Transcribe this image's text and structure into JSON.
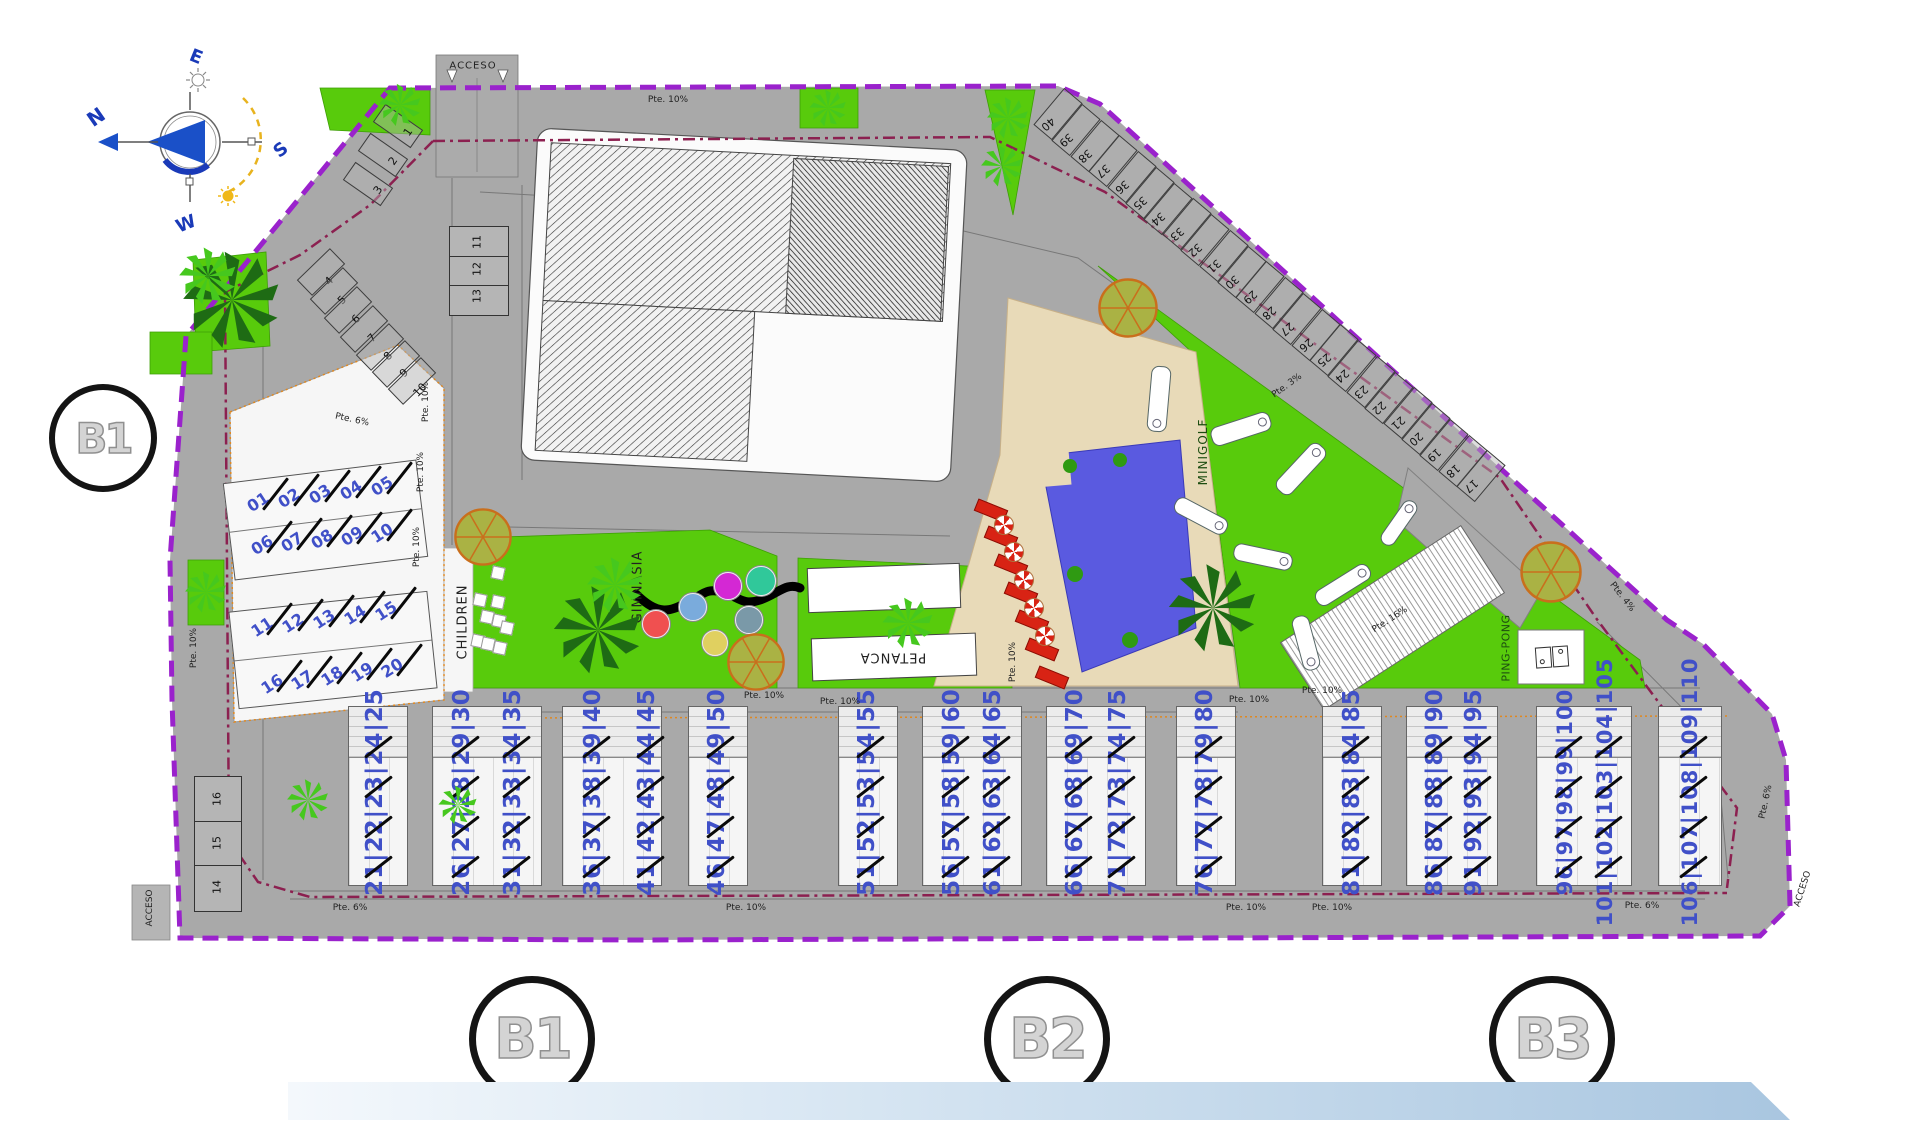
{
  "compass": {
    "n": "N",
    "e": "E",
    "s": "S",
    "w": "W"
  },
  "access": {
    "top": "ACCESO",
    "bottom_left": "ACCESO",
    "bottom_right": "ACCESO"
  },
  "markers": {
    "left": "B1",
    "bottom": [
      "B1",
      "B2",
      "B3"
    ]
  },
  "amenities": {
    "children": "CHILDREN",
    "gym": "GIMNASIA",
    "petanca": "PETANCA",
    "minigolf": "MINIGOLF",
    "pingpong": "PING-PONG"
  },
  "parking": {
    "left_curve": [
      "1",
      "2",
      "3",
      "4",
      "5",
      "6",
      "7",
      "8",
      "9",
      "10"
    ],
    "island": [
      "11",
      "12",
      "13"
    ],
    "bottom_left": [
      "16",
      "15",
      "14"
    ],
    "top_right": [
      "40",
      "39",
      "38",
      "37",
      "36",
      "35",
      "34",
      "33",
      "32",
      "31",
      "30",
      "29",
      "28",
      "27",
      "26",
      "25",
      "24",
      "23",
      "22",
      "21",
      "20",
      "19",
      "18",
      "17"
    ]
  },
  "b1_units": [
    "01",
    "02",
    "03",
    "04",
    "05",
    "06",
    "07",
    "08",
    "09",
    "10",
    "11",
    "12",
    "13",
    "14",
    "15",
    "16",
    "17",
    "18",
    "19",
    "20"
  ],
  "row_units": [
    "21|22|23|24|25",
    "26|27|28|29|30",
    "31|32|33|34|35",
    "36|37|38|39|40",
    "41|42|43|44|45",
    "46|47|48|49|50",
    "51|52|53|54|55",
    "56|57|58|59|60",
    "61|62|63|64|65",
    "66|67|68|69|70",
    "71|72|73|74|75",
    "76|77|78|79|80",
    "81|82|83|84|85",
    "86|87|88|89|90",
    "91|92|93|94|95",
    "96|97|98|99|100",
    "101|102|103|104|105",
    "106|107|108|109|110"
  ],
  "slopes": [
    "Pte. 10%",
    "Pte. 6%",
    "Pte. 10%",
    "Pte. 10%",
    "Pte. 10%",
    "Pte. 10%",
    "Pte. 3%",
    "Pte. 10%",
    "Pte. 10%",
    "Pte. 10%",
    "Pte. 10%",
    "Pte. 10%",
    "Pte. 16%",
    "Pte. 4%",
    "Pte. 6%",
    "Pte. 6%",
    "Pte. 6%",
    "Pte. 10%",
    "Pte. 10%",
    "Pte. 10%"
  ],
  "colors": {
    "boundary": "#9a22cc",
    "property_line": "#8c2050",
    "road": "#a9a9a9",
    "green": "#58cb0c",
    "pool": "#5a5ae0",
    "deck": "#e8dab8",
    "unit_number": "#4050c8",
    "lounger": "#d82314",
    "tree_ring": "#c96f1c"
  }
}
